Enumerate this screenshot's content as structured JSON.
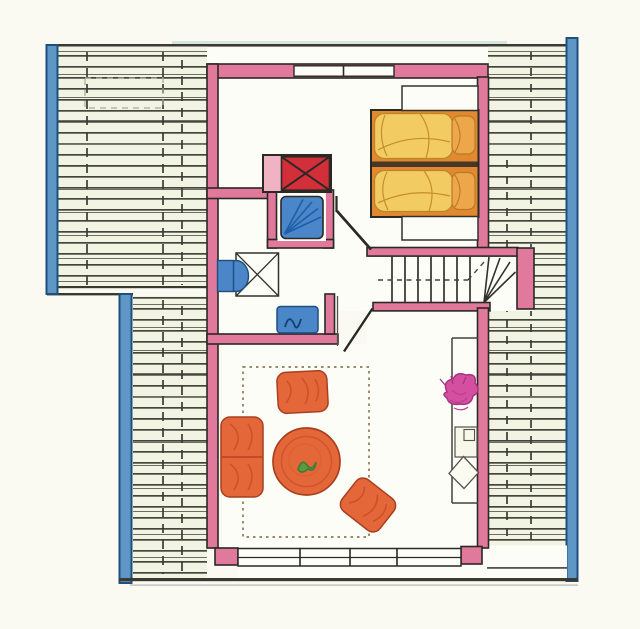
{
  "document": {
    "type": "hand-drawn attic floor plan",
    "visible_text": "",
    "description": "Colored pencil architectural plan of an attic apartment: hatched sloped-roof zones left and right, bedroom with double bed top right, bathroom with shower/washbasin/toilet center left, winder staircase center right, living room with sofa group below"
  },
  "colors": {
    "page_bg": "#fafaf3",
    "roof_bg": "#f2f4e3",
    "white_floor": "#fdfdf8",
    "ink": "#2b2924",
    "beam_blue": "#5e97c6",
    "beam_edge": "#1f4f7c",
    "wall_pink": "#e0799c",
    "wall_pink_light": "#f0b3c4",
    "chimney_red": "#d32f3a",
    "fixture_blue": "#4a86c8",
    "fixture_blue_dark": "#1f5fa8",
    "bed_orange": "#e2892f",
    "duvet_yellow": "#f2cb63",
    "pillow_orange": "#eda64a",
    "sofa_orange": "#e4673a",
    "sofa_shade": "#c94e26",
    "table_green": "#3f7d33",
    "plant_magenta": "#d44fa0",
    "rug_dash": "#8a7a58",
    "top_tint": "#cfe0d8"
  },
  "elements": {
    "roof_areas": [
      "upper-left hatched roof slope",
      "lower-left hatched roof slope",
      "right hatched roof slope"
    ],
    "windows": {
      "top_window_panes": 2,
      "bottom_window_panes": 4
    },
    "bedroom": {
      "bed_mattresses": 2,
      "nightstands": 2,
      "chimney": "red box with X cross"
    },
    "bathroom": {
      "items": [
        "shower cabin",
        "washbasin",
        "vanity square with X",
        "toilet"
      ]
    },
    "stairs": {
      "straight_treads": 8,
      "winder_treads": 4,
      "walk_line": "dashed"
    },
    "living_room": {
      "items": [
        "dashed-border rug",
        "armchair",
        "two-seat sofa",
        "round table with green plant centerpiece",
        "second armchair",
        "sideboard",
        "potted magenta plant",
        "small box",
        "diamond object"
      ]
    }
  }
}
